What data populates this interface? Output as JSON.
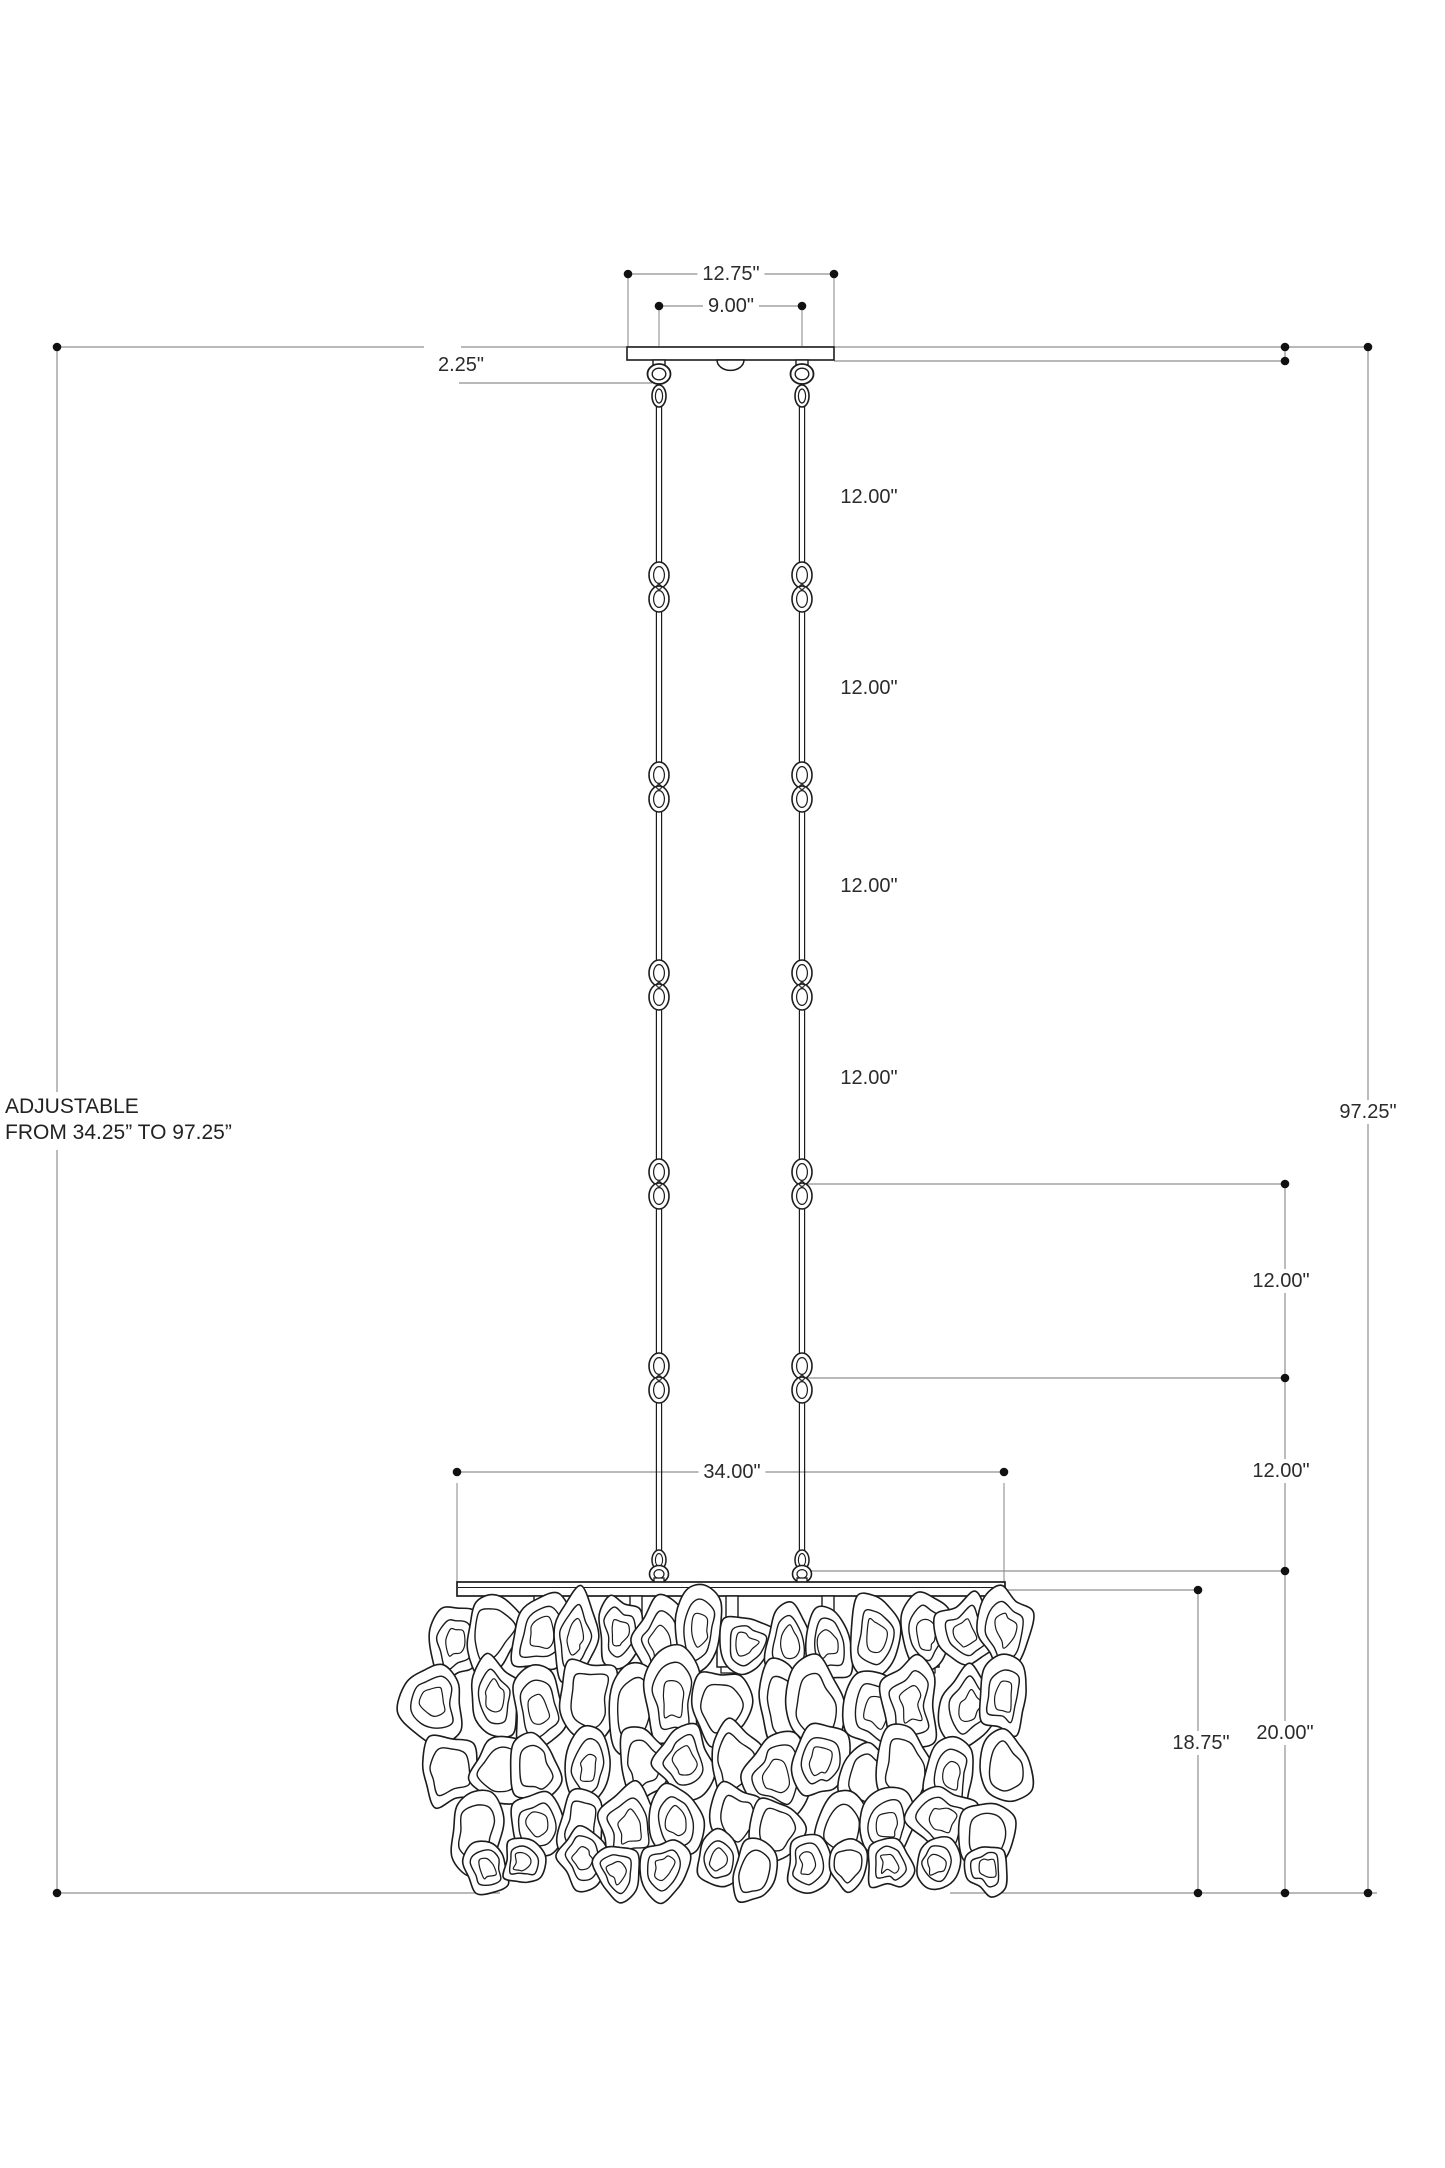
{
  "drawing": {
    "type": "chandelier installation dimension drawing",
    "background": "#ffffff"
  },
  "colors": {
    "dimension_line": "#8f8f8f",
    "artwork_ink": "#1c1c1c",
    "label_text": "#2b2b2b",
    "dot": "#111111"
  },
  "annotation": {
    "line1": "ADJUSTABLE",
    "line2": "FROM 34.25” TO 97.25”"
  },
  "dims": {
    "canopy_width": "12.75\"",
    "hang_spacing": "9.00\"",
    "canopy_height": "2.25\"",
    "chain_segment": "12.00\"",
    "overall_height": "97.25\"",
    "fixture_width": "34.00\"",
    "fixture_height": "20.00\"",
    "shell_drop": "18.75\""
  }
}
